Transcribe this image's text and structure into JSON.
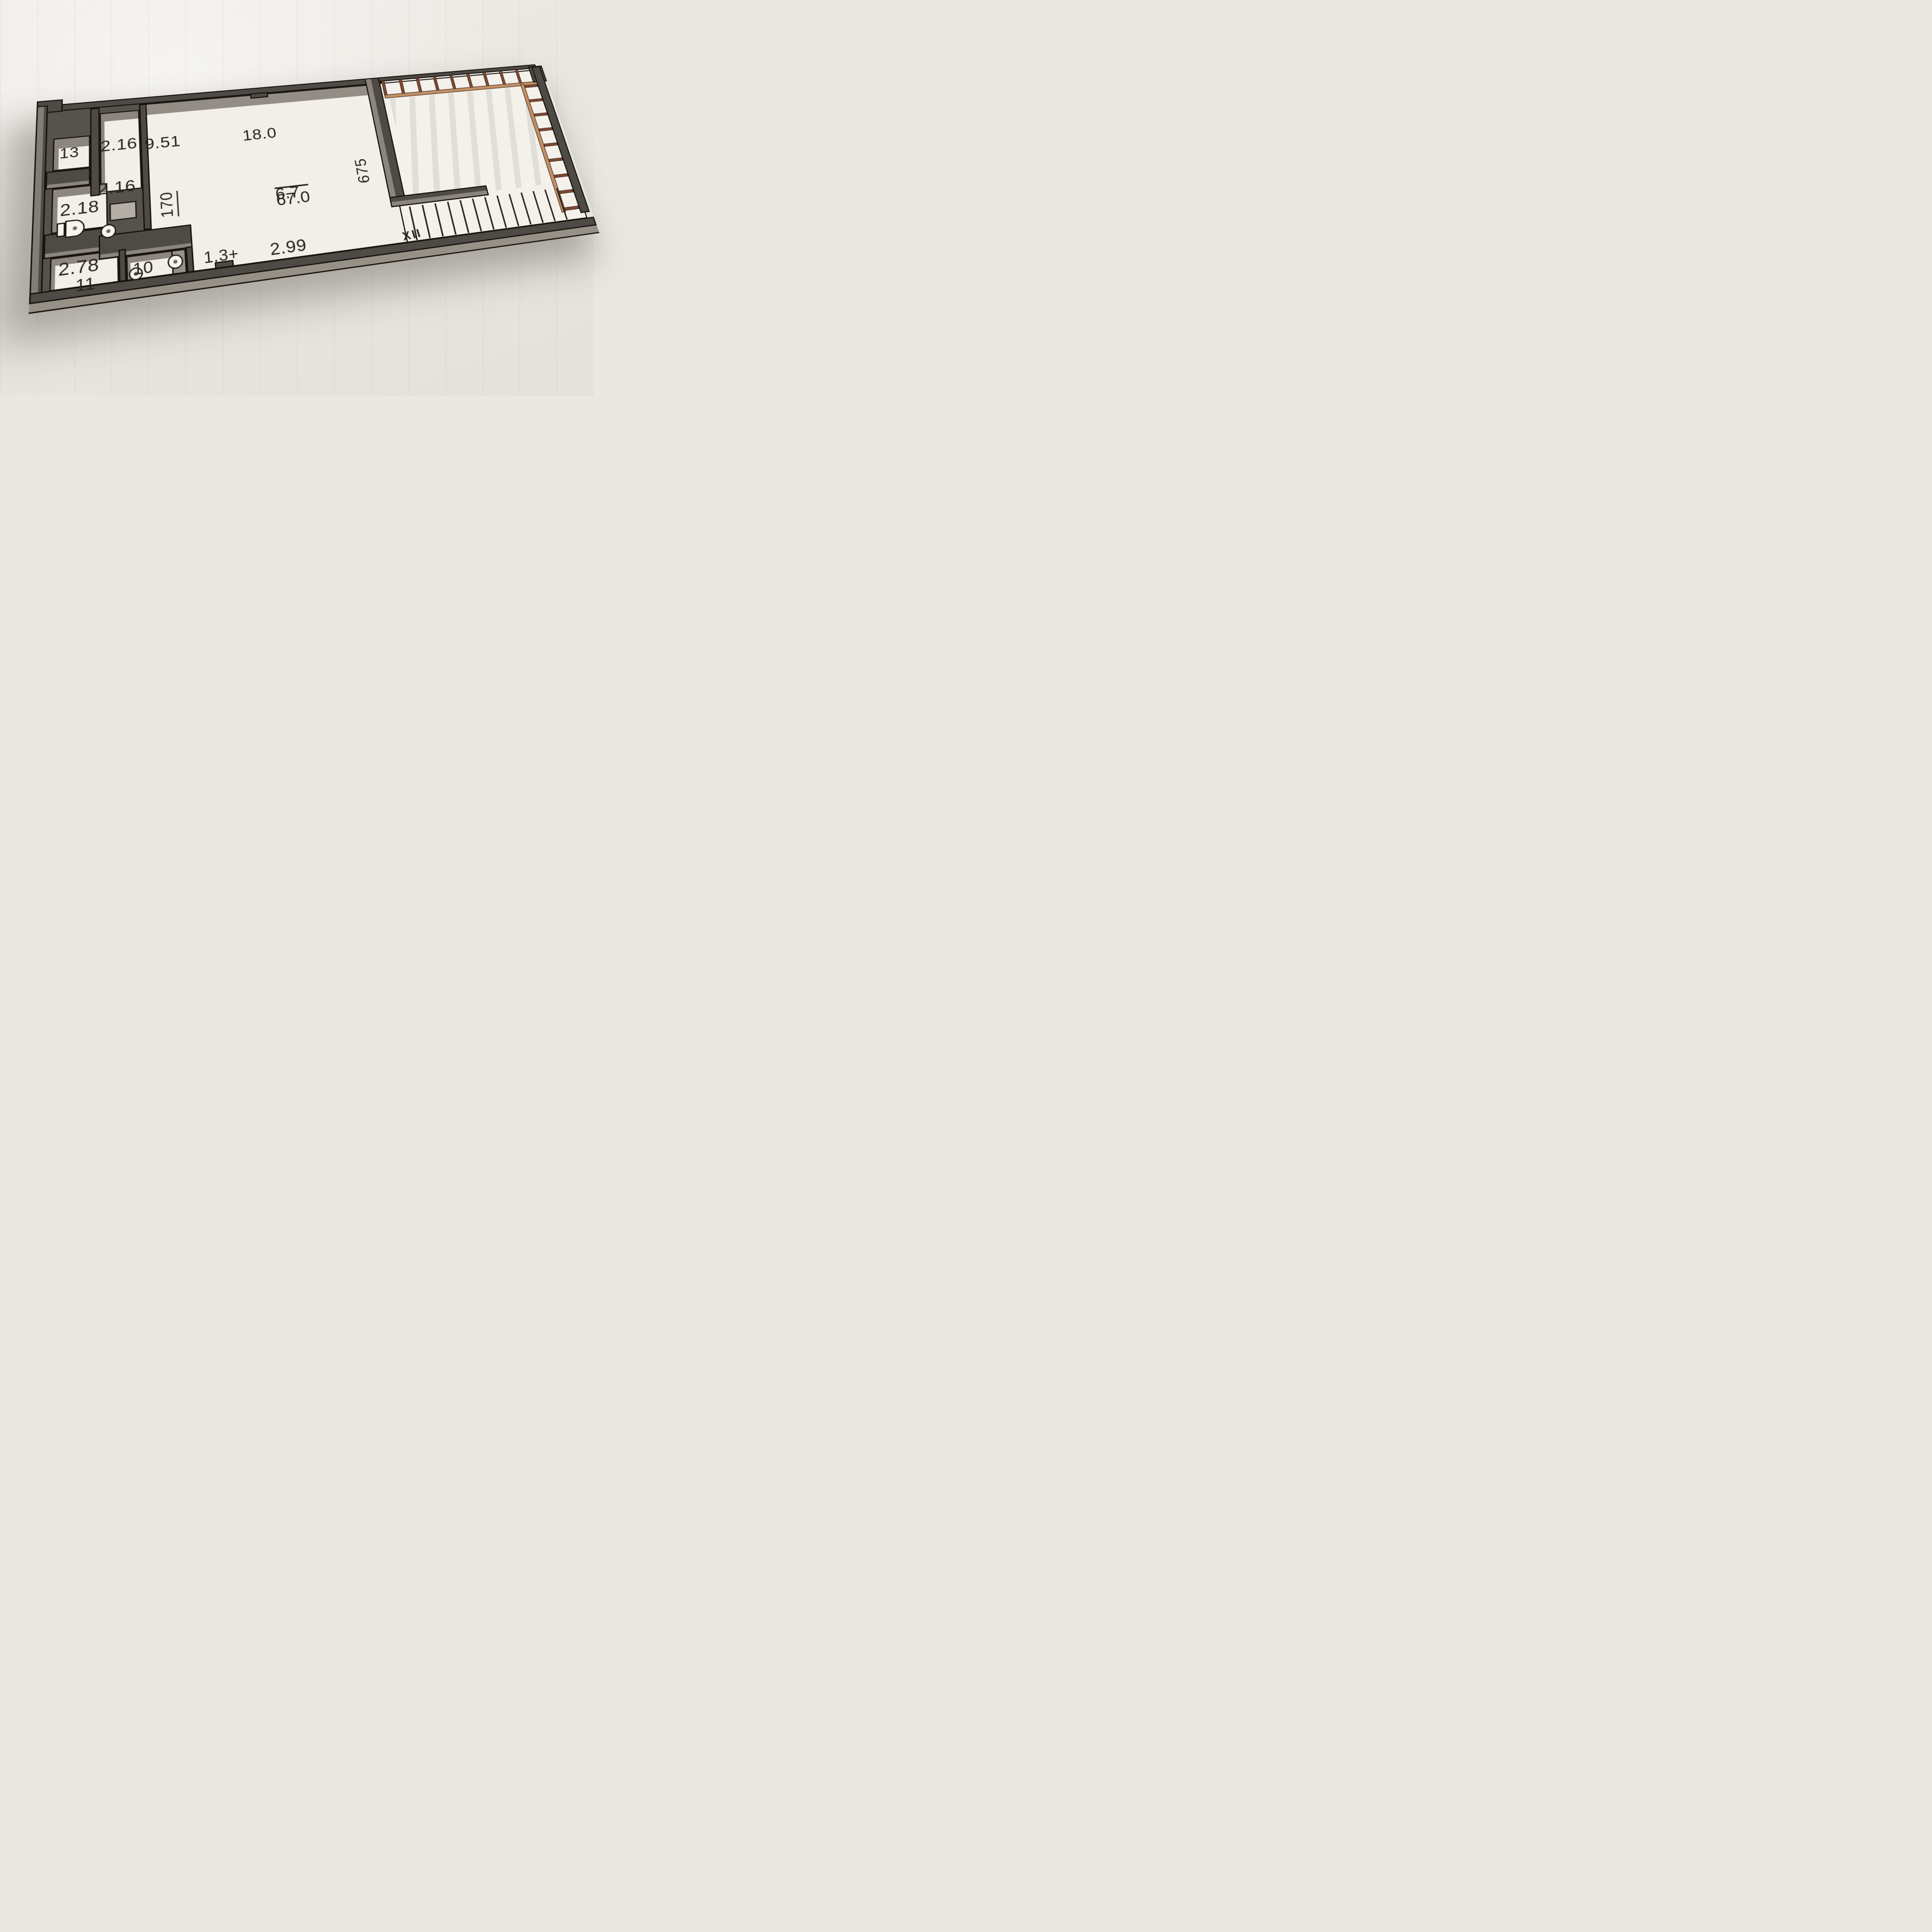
{
  "labels": {
    "room13": "13",
    "hall_top": "2.16",
    "hall_bottom": "2.16",
    "corridor_area": "9.51",
    "bath": "2.18",
    "storage_area": "2.78",
    "room11": "11",
    "room10": "10",
    "living_area": "18.0",
    "area_numerator": "6.7",
    "area_denominator": "67.0",
    "dim_width": "2.99",
    "dim_kitchen": "1.3+",
    "dim_length": "675",
    "dim_corridor": "170",
    "stairs_mark": "XII"
  },
  "colors": {
    "wall": "#4e4a45",
    "wall_face": "#8b857d",
    "outline": "#1b1713",
    "floor": "#f2efe9",
    "floor_shaded": "#8f8a83",
    "wall_mass": "#56524c",
    "background": "#ebe8e2",
    "railing_wood": "#7b4833",
    "railing_sill": "#c29067",
    "text": "#2a2520"
  },
  "railing": {
    "top_post_count": 10,
    "right_post_count": 9
  },
  "stairs": {
    "tread_count": 13
  }
}
